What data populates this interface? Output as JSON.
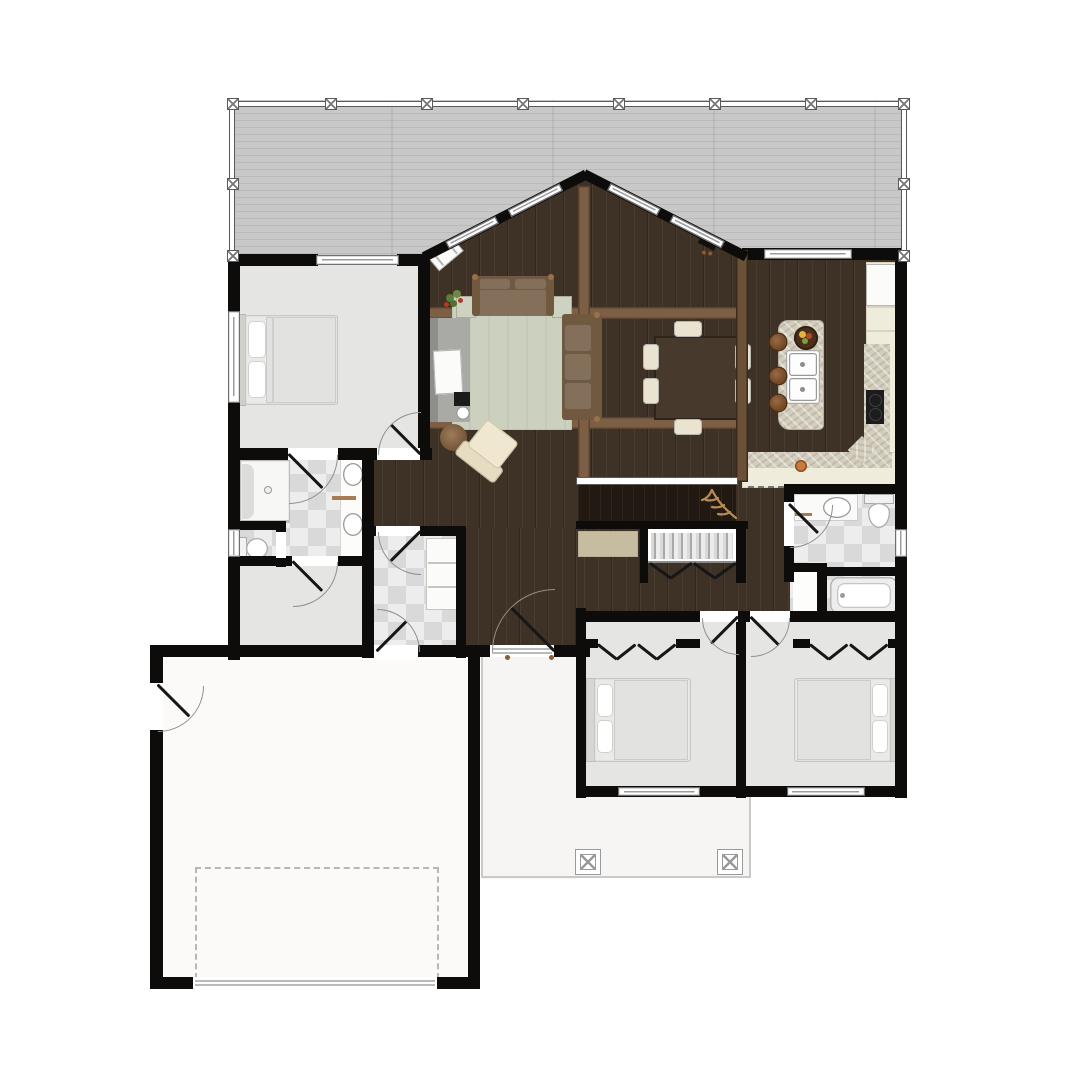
{
  "document": {
    "type": "residential floor plan",
    "view": "top-down furnished color rendering",
    "text_labels_visible": false,
    "storeys_shown": 1
  },
  "palette": {
    "wall": "#0d0c0b",
    "wood1": "#3e3125",
    "deck1": "#c8c8c8",
    "light": "#e5e6e3",
    "tileA": "#ededed",
    "tileB": "#d9d9d9",
    "beam": "#7d5f45",
    "beamEdge": "#5b4430",
    "beamwall": "#6a5138",
    "marble": "#d3cdbd",
    "cream": "#f0ecdc",
    "rug": "#ccd1bf",
    "sofa": "#70593f",
    "cushion": "#84705a",
    "porch": "#f6f5f3",
    "garage": "#fbfaf8",
    "leaf": "#161616",
    "stair": "#221a12",
    "tanrug": "#c6bca0",
    "antler": "#b98c55",
    "fruit_yellow": "#e0b73c",
    "fruit_red": "#b64a2a",
    "plant_green": "#5d7a3a",
    "berry_red": "#b03a2a",
    "pot_orange": "#c87b3e"
  },
  "rooms": [
    {
      "id": "deck",
      "name": "rear deck",
      "floor": "gray plank decking",
      "features": [
        "perimeter railing",
        "railing posts"
      ]
    },
    {
      "id": "great-room",
      "name": "great room with prow front",
      "floor": "dark hardwood",
      "features": [
        "angled window walls",
        "peak apex",
        "ceiling beams"
      ],
      "furniture": [
        "loveseat",
        "three-seat sofa",
        "area rug",
        "two side tables",
        "armchair",
        "round ottoman",
        "media console with TV",
        "fireplace box",
        "corner bench",
        "potted plant"
      ]
    },
    {
      "id": "dining-area",
      "name": "dining area",
      "floor": "dark hardwood",
      "furniture": [
        "rectangular table",
        "six chairs"
      ]
    },
    {
      "id": "kitchen",
      "name": "kitchen",
      "floor": "dark hardwood",
      "furniture": [
        "island with double sink",
        "fruit bowl",
        "three bar stools",
        "L-shaped granite counter",
        "cooktop",
        "refrigerator",
        "pantry cabinets",
        "orange pot"
      ]
    },
    {
      "id": "master-bedroom",
      "name": "primary bedroom",
      "floor": "light carpet",
      "furniture": [
        "bed with two pillows"
      ],
      "features": [
        "sliding door to deck",
        "side window",
        "entry door",
        "ensuite door"
      ]
    },
    {
      "id": "master-bathroom",
      "name": "primary bathroom",
      "floor": "checkerboard tile",
      "fixtures": [
        "walk-in shower with bench",
        "double sink vanity",
        "toilet compartment"
      ]
    },
    {
      "id": "walk-in-closet",
      "name": "walk-in closet",
      "floor": "light carpet",
      "features": [
        "swing door"
      ]
    },
    {
      "id": "laundry-room",
      "name": "laundry / mudroom",
      "floor": "checkerboard tile",
      "furniture": [
        "cabinet"
      ],
      "features": [
        "hall door",
        "garage door"
      ]
    },
    {
      "id": "hallway",
      "name": "hallway",
      "floor": "dark hardwood",
      "furniture": [
        "tan runner rug"
      ],
      "features": [
        "front entry door with sidelight sill",
        "hall linen closet with bifold doors"
      ]
    },
    {
      "id": "stairwell",
      "name": "stair to lower level",
      "features": [
        "two railings",
        "antler decor"
      ]
    },
    {
      "id": "bathroom-2",
      "name": "hall bathroom",
      "floor": "checkerboard tile",
      "fixtures": [
        "vanity sink",
        "toilet",
        "bathtub",
        "linen closet"
      ],
      "features": [
        "window"
      ]
    },
    {
      "id": "bedroom-2",
      "name": "bedroom 2",
      "floor": "light carpet",
      "furniture": [
        "bed with two pillows"
      ],
      "features": [
        "closet with bifold doors",
        "window"
      ]
    },
    {
      "id": "bedroom-3",
      "name": "bedroom 3",
      "floor": "light carpet",
      "furniture": [
        "bed with two pillows"
      ],
      "features": [
        "closet with bifold doors",
        "window"
      ]
    },
    {
      "id": "garage",
      "name": "garage",
      "floor": "concrete",
      "features": [
        "dashed parking stall",
        "wide garage door",
        "side entry door"
      ]
    },
    {
      "id": "covered-porch",
      "name": "covered entry porch",
      "features": [
        "two square columns",
        "front door"
      ]
    }
  ],
  "counts": {
    "bedrooms": 3,
    "bathrooms": 2,
    "deck_railing_posts": 12,
    "porch_columns": 2,
    "dining_chairs": 6,
    "bar_stools": 3
  }
}
